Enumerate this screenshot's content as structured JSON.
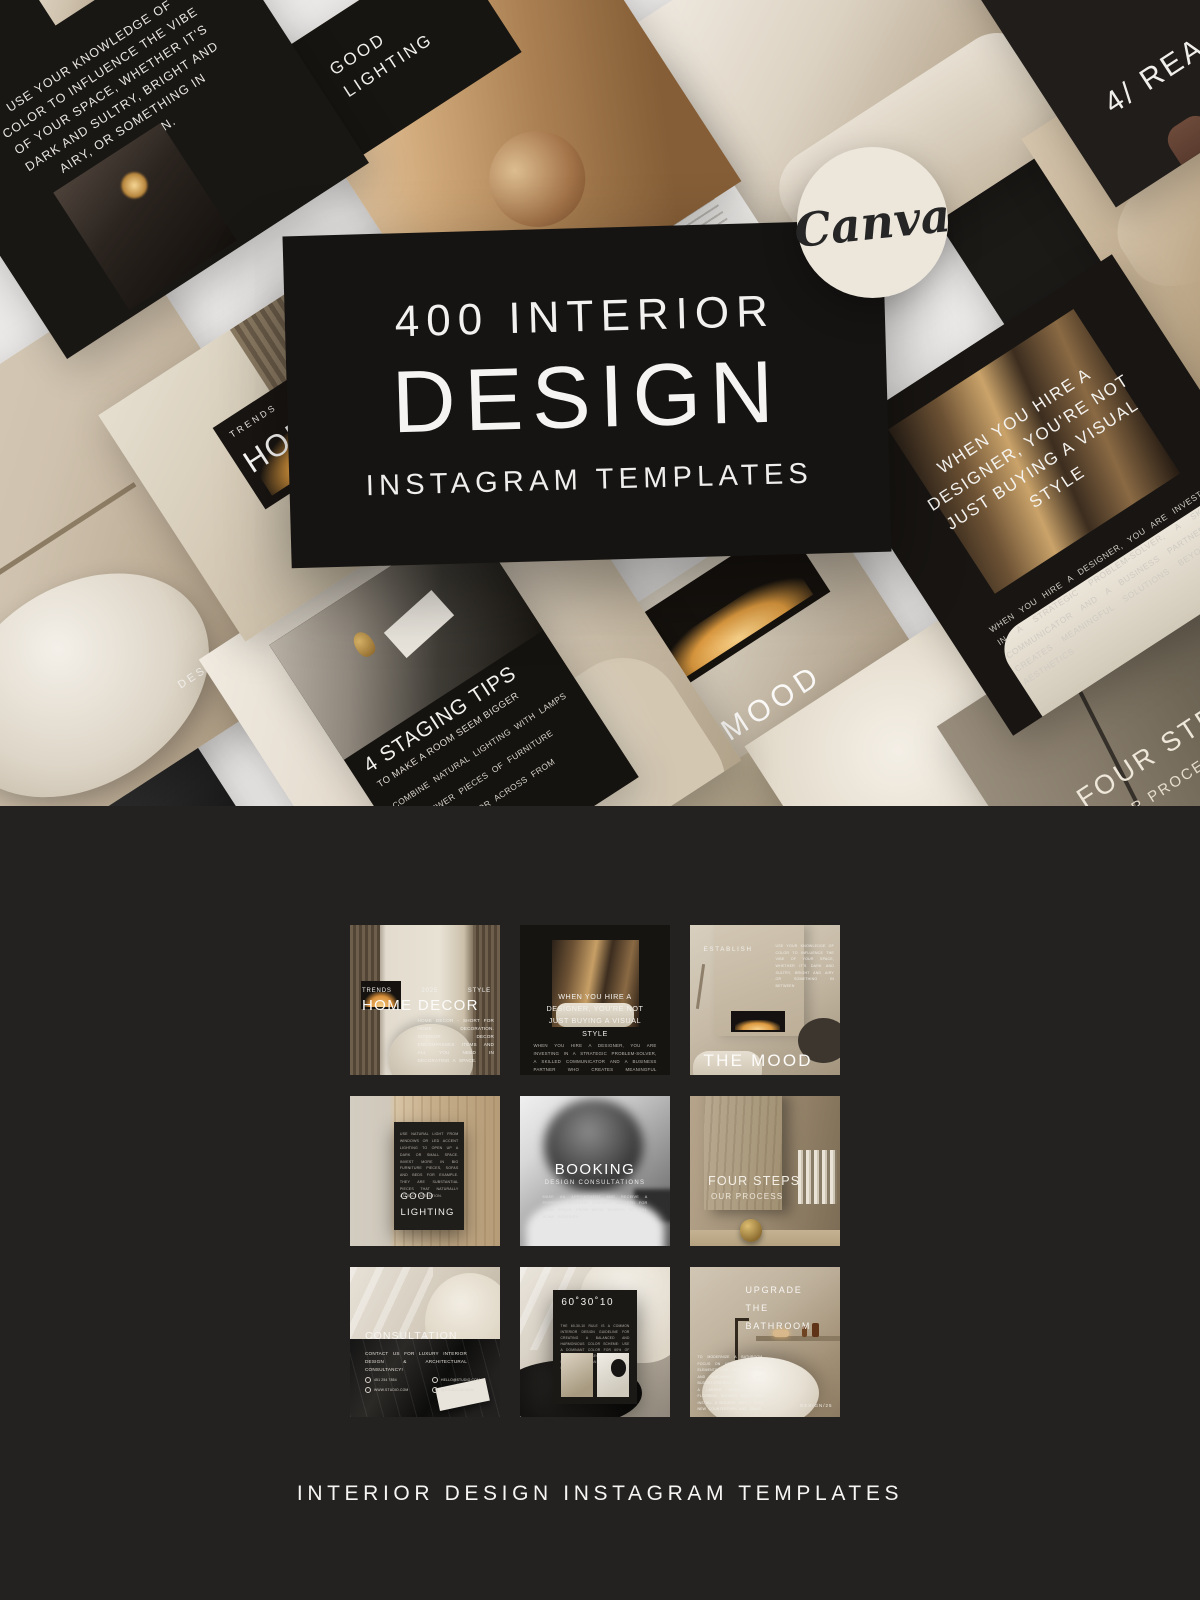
{
  "page": {
    "footer_caption": "INTERIOR DESIGN INSTAGRAM TEMPLATES",
    "colors": {
      "hero_bg": "#EBE9E7",
      "dark_bg": "#242220",
      "banner_bg": "#161412",
      "badge_bg": "#ECE6DB"
    }
  },
  "hero": {
    "badge_label": "Canva",
    "title_line1": "400 INTERIOR",
    "title_line2": "DESIGN",
    "title_line3": "INSTAGRAM TEMPLATES"
  },
  "collage": {
    "color_vibe_text": "USE YOUR KNOWLEDGE OF\nCOLOR TO INFLUENCE THE VIBE\nOF YOUR SPACE, WHETHER IT'S\nDARK AND SULTRY, BRIGHT AND\nAIRY, OR SOMETHING IN\nBETWEEN.",
    "good_lighting": "GOOD\nLIGHTING",
    "sunday_title": "SUNDAY\nENERGY",
    "sunday_tag": "Tips &\ntricks",
    "reasons_title": "4/ REASONS",
    "textile_fragment": "TEXTILE\nEY LOOKED\nY IN TWO\nES - TH\nRE",
    "home_kicker": "TRENDS",
    "home_title": "HOME DECOR",
    "home_year": "2025",
    "bath_title": "UPGRADE THE\nBATHROOM",
    "bath_fragment": "ROOM\nO KEY\nIGHTING\nCH ARE\nOPTIONS\nT UPDATE\nWALLS\nRN VANITY\nTOPS AND",
    "bath_tag": "DESIGN/25",
    "staging_title": "4 STAGING TIPS",
    "staging_subtitle": "TO MAKE A ROOM SEEM BIGGER",
    "staging_tip1": "COMBINE NATURAL LIGHTING WITH LAMPS",
    "staging_tip2": "USE FEWER PIECES OF FURNITURE",
    "staging_tip3": "PLACE A MIRROR ACROSS FROM",
    "mood_title": "THE MOOD",
    "designer_headline": "WHEN YOU HIRE A\nDESIGNER, YOU'RE NOT\nJUST BUYING A VISUAL\nSTYLE",
    "designer_body": "WHEN YOU HIRE A DESIGNER, YOU ARE INVESTING IN A STRATEGIC PROBLEM-SOLVER, A SKILLED COMMUNICATOR AND A BUSINESS PARTNER WHO CREATES MEANINGFUL SOLUTIONS BEYOND JUST AESTHETICS",
    "four_steps_title": "FOUR STEPS",
    "four_steps_subtitle": "OUR PROCESS"
  },
  "grid": {
    "home_decor": {
      "kicker_left": "TRENDS",
      "kicker_mid": "2025",
      "kicker_right": "STYLE",
      "title": "HOME DECOR",
      "body": "HOME DECOR - SHORT FOR HOME DECORATION. INTERIOR DECOR ENCOMPASSES ITEMS AND ALL YOU NEED IN DECORATING A SPACE."
    },
    "designer_quote": {
      "headline": "WHEN YOU HIRE A\nDESIGNER, YOU'RE NOT\nJUST BUYING A VISUAL\nSTYLE",
      "body": "WHEN YOU HIRE A DESIGNER, YOU ARE INVESTING IN A STRATEGIC PROBLEM-SOLVER, A SKILLED COMMUNICATOR AND A BUSINESS PARTNER WHO CREATES MEANINGFUL SOLUTIONS BEYOND JUST AESTHETICS."
    },
    "the_mood": {
      "kicker": "ESTABLISH",
      "side_note": "USE YOUR KNOWLEDGE OF COLOR TO INFLUENCE THE VIBE OF YOUR SPACE, WHETHER IT'S DARK AND SULTRY, BRIGHT AND AIRY OR SOMETHING IN BETWEEN",
      "title": "THE MOOD"
    },
    "good_lighting": {
      "body": "USE NATURAL LIGHT FROM WINDOWS OR LED ACCENT LIGHTING TO OPEN UP A DARK OR SMALL SPACE. INVEST MORE IN BIG FURNITURE PIECES, SOFAS AND BEDS FOR EXAMPLE. THEY ARE SUBSTANTIAL PIECES THAT NATURALLY ATTRACT ATTENTION.",
      "title": "GOOD\nLIGHTING"
    },
    "booking": {
      "title": "BOOKING",
      "subtitle": "DESIGN CONSULTATIONS",
      "body": "MAKE AN APPOINTMENT AND RECEIVE A PERSONAL INTERIOR CONCEPT TAILORED FOR YOUR SPACE, FROM MOOD BOARDS TO FULL HOME REDESIGN."
    },
    "four_steps": {
      "title": "FOUR STEPS",
      "subtitle": "OUR PROCESS"
    },
    "consultation": {
      "title": "CONSULTATION",
      "body": "CONTACT US FOR LUXURY INTERIOR DESIGN & ARCHITECTURAL CONSULTANCY!",
      "contacts": [
        "451 254 7854",
        "HELLO@STUDIO.COM",
        "WWW.STUDIO.COM",
        "@STUDIO.DESIGN"
      ]
    },
    "rule_603010": {
      "title": "60˚30˚10",
      "body": "THE 60-30-10 RULE IS A COMMON INTERIOR DESIGN GUIDELINE FOR CREATING A BALANCED AND HARMONIOUS COLOR SCHEME: USE A DOMINANT COLOR FOR 60% OF THE ROOM, A SECONDARY COLOR FOR 30% AND AN ACCENT COLOR FOR 10%."
    },
    "upgrade_bathroom": {
      "title": "UPGRADE THE\nBATHROOM",
      "body": "TO MODERNIZE A BATHROOM, FOCUS ON UPDATES TO KEY ELEMENTS LIKE PAINT, LIGHTING AND HARDWARE, WHICH ARE BUDGET-FRIENDLY OPTIONS. FOR A LARGER IMPACT UPDATE FLOORING, SHOWER WALLS AND INSTALL A MODERN VANITY WITH NEW COUNTERTOPS AND SINKS.",
      "tag": "DESIGN/25"
    }
  }
}
